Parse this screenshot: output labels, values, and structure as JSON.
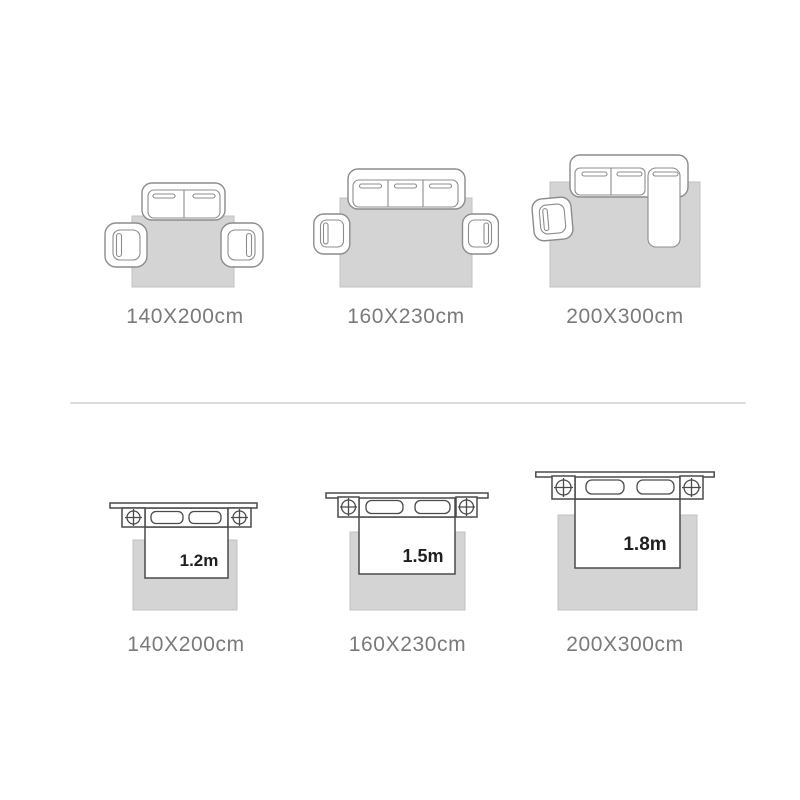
{
  "colors": {
    "background": "#ffffff",
    "rug_fill": "#d4d4d4",
    "rug_stroke": "#c2c2c2",
    "sofa_stroke": "#8c8c8c",
    "bed_stroke": "#4a4a4a",
    "caption_text": "#7a7a7a",
    "bed_label_text": "#1f1f1f",
    "divider": "#dcdcdc"
  },
  "sofa_rugs": {
    "items": [
      {
        "icon": "two-seat-sofa-with-two-armchairs-rug",
        "caption": "140X200cm"
      },
      {
        "icon": "three-seat-sofa-with-two-armchairs-rug",
        "caption": "160X230cm"
      },
      {
        "icon": "sectional-sofa-with-armchair-rug",
        "caption": "200X300cm"
      }
    ]
  },
  "bed_rugs": {
    "items": [
      {
        "icon": "bed-with-nightstands-rug",
        "caption": "140X200cm",
        "bed_width": "1.2m"
      },
      {
        "icon": "bed-with-nightstands-rug",
        "caption": "160X230cm",
        "bed_width": "1.5m"
      },
      {
        "icon": "bed-with-nightstands-rug",
        "caption": "200X300cm",
        "bed_width": "1.8m"
      }
    ]
  }
}
